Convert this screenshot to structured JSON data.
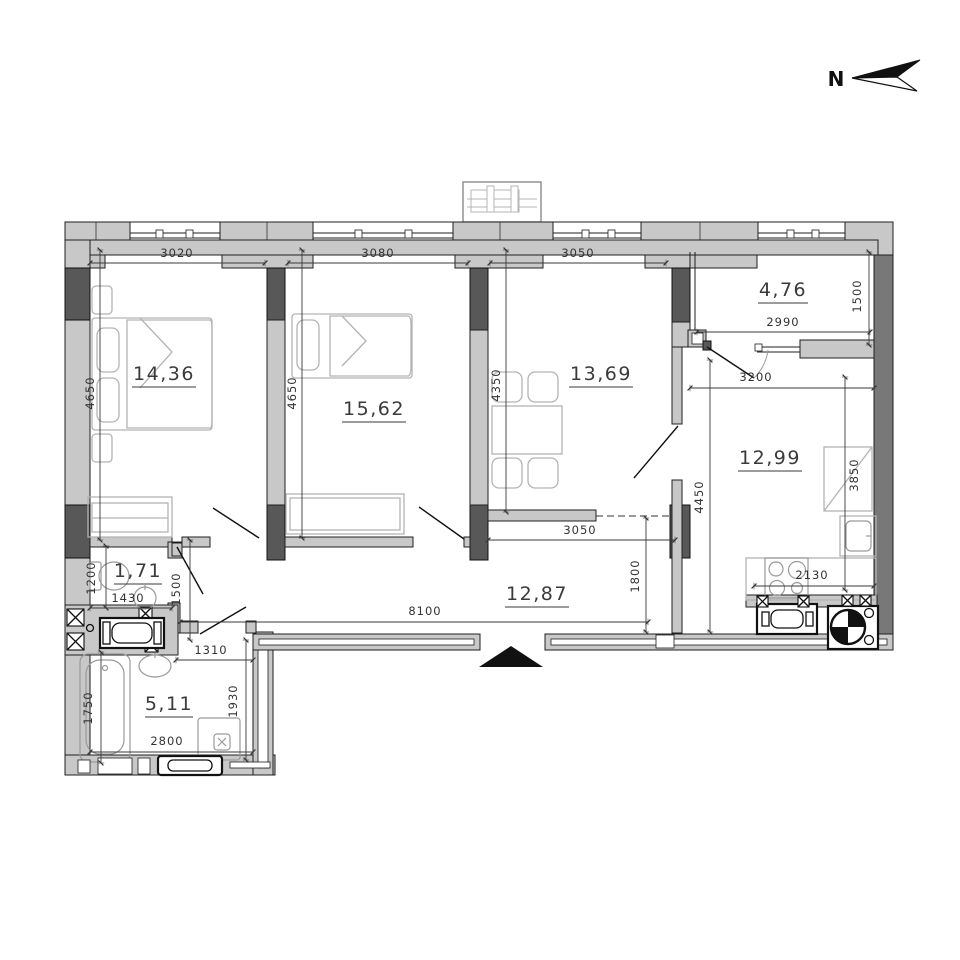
{
  "compass": {
    "label": "N"
  },
  "rooms": [
    {
      "name": "bedroom-1",
      "area": "14,36"
    },
    {
      "name": "bedroom-2",
      "area": "15,62"
    },
    {
      "name": "dining-room",
      "area": "13,69"
    },
    {
      "name": "balcony",
      "area": "4,76"
    },
    {
      "name": "kitchen",
      "area": "12,99"
    },
    {
      "name": "hallway",
      "area": "12,87"
    },
    {
      "name": "wc",
      "area": "1,71"
    },
    {
      "name": "bathroom",
      "area": "5,11"
    }
  ],
  "dims": {
    "d3020": "3020",
    "d3080": "3080",
    "d3050_top": "3050",
    "d4650_a": "4650",
    "d4650_b": "4650",
    "d4350": "4350",
    "d2990": "2990",
    "d1500_balcony": "1500",
    "d3200": "3200",
    "d4450": "4450",
    "d3850": "3850",
    "d2130": "2130",
    "d8100": "8100",
    "d3050_hall": "3050",
    "d1800": "1800",
    "d1200": "1200",
    "d1430": "1430",
    "d1500_wc": "1500",
    "d1310": "1310",
    "d1930": "1930",
    "d2800": "2800",
    "d1750": "1750"
  }
}
